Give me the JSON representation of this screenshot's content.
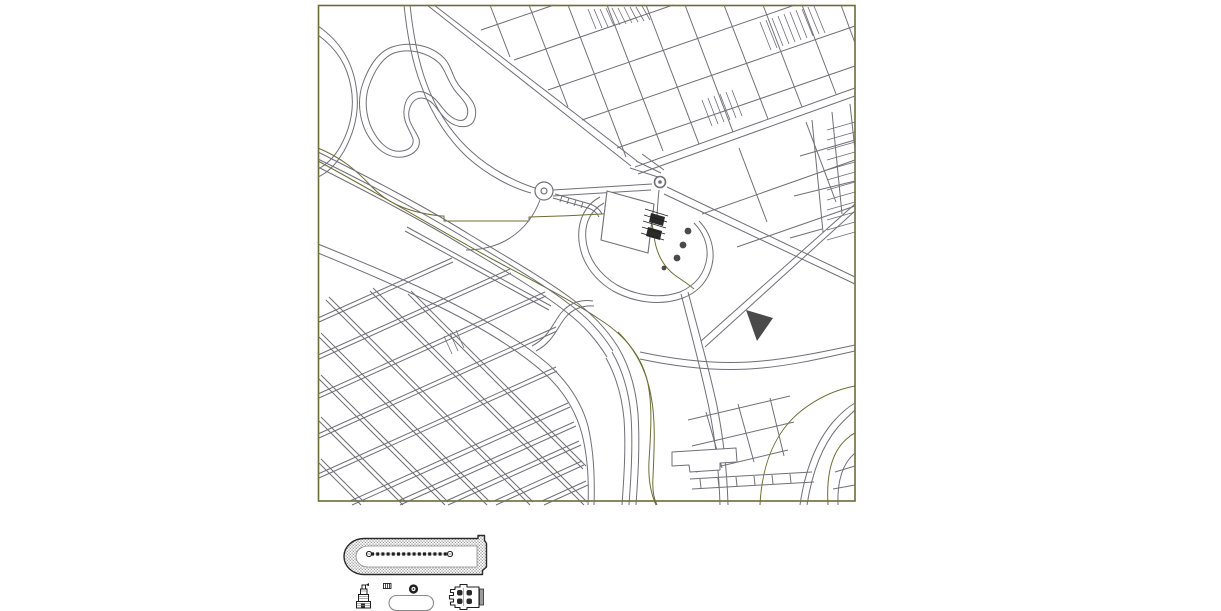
{
  "canvas": {
    "width": 1221,
    "height": 611,
    "background": "#ffffff"
  },
  "colors": {
    "olive": "#6c6c34",
    "street": "#6f6f78",
    "dark": "#1f1f1f",
    "wall": "#2a2a2a",
    "stipple": "#9c9c9c",
    "gray": "#8a8a8a",
    "tree": "#4a4a4a",
    "white": "#ffffff"
  },
  "frame": {
    "x": 318.5,
    "y": 5.5,
    "w": 536.5,
    "h": 495.5
  },
  "layers": [
    {
      "name": "park-contours-olive",
      "stroke": "olive",
      "w": 1,
      "paths": [
        "M318,148 C342,158 356,170 372,187 C390,206 414,213 441,216 L444,216 L444,221 L529,221 L529,217 L560,216 C588,215 618,213 639,212 C650,212 652,220 654,236 C656,252 662,266 676,276 C682,280 688,284 694,289",
        "M318,161 C372,190 432,226 492,259 C541,285 572,301 599,319 C623,334 639,353 646,376 C653,399 651,431 649,461 C648,481 651,494 656,505",
        "M618,332 C637,351 647,373 651,396 C656,421 654,452 653,477 C652,491 654,499 657,505",
        "M828,505 C826,472 833,449 849,437 C851,435 853,434 855,433",
        "M760,505 C762,463 776,431 801,411 C820,396 839,389 855,386"
      ]
    },
    {
      "name": "park-roads",
      "stroke": "street",
      "w": 1,
      "paths": [
        "M318,26 C340,41 352,61 356,86 C360,109 355,131 344,151 C335,166 327,173 318,177",
        "M318,35 C337,49 347,65 351,87 C355,109 350,129 340,147 C333,159 326,165 318,169",
        "M392,47 C410,41 431,45 444,58 C452,66 452,78 461,88 C471,98 478,106 475,118 C472,129 458,129 448,121 C439,114 436,104 428,100 C419,95 411,100 409,111 C407,122 415,129 419,139 C421,147 415,155 403,157 C387,159 375,148 367,134 C359,119 357,99 363,83 C369,66 378,52 392,47 Z",
        "M394,53 C409,48 427,52 439,63 C446,70 447,81 456,92 C464,101 470,107 467,116 C464,123 456,121 449,115 C441,108 438,99 428,94 C417,88 405,94 404,111 C403,122 410,130 413,139 C414,145 410,150 402,151 C390,153 380,144 373,131 C366,118 364,100 369,86 C374,71 383,57 394,53 Z",
        "M410,5 C413,33 418,60 426,82 C436,110 452,134 472,152 C492,170 516,182 535,188",
        "M404,5 C407,34 412,62 421,85 C431,113 447,138 467,157 C487,175 512,188 531,193",
        "M427,5 L631,166",
        "M434,5 L637,161",
        "M553,190 L652,184",
        "M553,196 L651,190",
        "M553,198 L588,208 C594,210 597,213 599,217",
        "M555,194 L590,204 C596,206 600,210 602,214",
        "M562,196 L560,202",
        "M569,198 L567,204",
        "M576,200 L574,206",
        "M583,202 L581,208",
        "M630,168 L658,177",
        "M636,161 L661,173",
        "M642,154 L664,170",
        "M540,200 C534,216 524,229 510,238 C498,246 482,250 466,250",
        "M659,190 C658,200 657,210 657,220"
      ]
    },
    {
      "name": "grid-northeast",
      "stroke": "street",
      "w": 1,
      "paths": [
        "M481,30 L554,5",
        "M514,60 L673,5",
        "M548,90 L795,5",
        "M582,120 L855,26",
        "M617,148 L855,66",
        "M635,167 L855,88",
        "M638,174 L855,96",
        "M702,214 L855,160",
        "M737,247 L855,206",
        "M490,5 L510,57",
        "M529,5 L568,107",
        "M568,5 L626,157",
        "M607,5 L663,151",
        "M646,5 L699,144",
        "M685,5 L733,132",
        "M724,5 L768,119",
        "M763,5 L802,107",
        "M802,5 L836,94",
        "M841,5 L855,43",
        "M739,148 L767,222",
        "M806,122 L836,202",
        "M812,120 L823,232",
        "M832,112 L842,214",
        "M850,104 L855,150",
        "M800,156 L855,140",
        "M794,196 L855,181",
        "M790,238 L822,229",
        "M667,187 L855,277",
        "M664,194 L855,284",
        "M701,341 L855,204",
        "M705,347 L855,211",
        "M688,292 C698,330 709,368 717,406 C723,436 727,470 728,505",
        "M681,294 C691,332 701,370 709,408 C715,438 719,471 720,505"
      ]
    },
    {
      "name": "lot-hatch-strips",
      "stroke": "street",
      "w": 0.8,
      "paths": [
        "M588,9 L596,29",
        "M594,9 L602,28",
        "M600,9 L608,27",
        "M606,8 L614,26",
        "M612,8 L620,25",
        "M618,8 L626,24",
        "M624,7 L632,23",
        "M630,7 L638,22",
        "M636,7 L644,21",
        "M642,6 L650,20",
        "M760,22 L771,50",
        "M766,20 L777,48",
        "M772,18 L783,46",
        "M778,16 L789,44",
        "M784,14 L795,42",
        "M790,12 L801,40",
        "M796,10 L807,38",
        "M802,9 L813,36",
        "M808,7 L819,34",
        "M814,6 L825,33",
        "M827,130 L855,122",
        "M827,140 L855,132",
        "M827,150 L855,142",
        "M827,160 L855,152",
        "M827,170 L855,162",
        "M827,180 L855,172",
        "M827,190 L855,182",
        "M827,200 L855,192",
        "M827,210 L855,202",
        "M827,220 L855,212",
        "M827,230 L855,222",
        "M827,240 L855,232",
        "M702,100 L712,126",
        "M708,98 L718,124",
        "M714,96 L724,122",
        "M720,94 L730,120",
        "M726,92 L736,118",
        "M732,90 L742,116",
        "M444,336 L452,354",
        "M450,333 L458,351",
        "M456,330 L464,348"
      ]
    },
    {
      "name": "rail-and-river",
      "stroke": "street",
      "w": 1,
      "paths": [
        "M318,152 C372,179 424,206 472,236 C514,261 548,281 572,299 C594,315 608,331 618,347",
        "M318,159 C371,185 422,212 470,241 C512,266 546,286 569,304 C590,319 603,335 613,351",
        "M318,167 C369,193 420,219 467,248 C509,273 542,293 565,311 C585,326 597,341 607,357",
        "M405,231 C452,257 502,284 549,310",
        "M407,227 C454,253 504,280 551,306",
        "M618,347 C630,367 636,390 638,414 C640,445 638,476 636,505",
        "M612,352 C623,371 629,393 631,416 C633,446 631,477 629,505",
        "M606,358 C616,376 622,397 624,419 C626,447 624,477 622,505",
        "M318,253 C362,271 404,289 444,309 C484,329 519,351 544,373 C564,391 576,412 582,434 C588,458 589,482 588,505",
        "M318,244 C362,262 406,280 446,300 C486,320 522,342 548,364 C569,383 582,404 588,426 C594,452 595,478 594,505",
        "M532,346 C549,337 553,323 561,313 C569,303 581,299 593,301",
        "M536,351 C553,342 557,328 565,318 C572,309 583,305 594,306",
        "M640,352 C682,361 722,365 762,361 C794,358 827,351 855,345",
        "M640,359 C682,368 722,372 762,368 C795,365 828,357 855,351",
        "M690,479 L812,472",
        "M692,489 L814,482",
        "M700,479 L701,488",
        "M718,478 L719,487",
        "M736,477 L737,486",
        "M754,476 L755,485",
        "M772,475 L773,484",
        "M790,474 L791,483"
      ]
    },
    {
      "name": "grid-southwest",
      "stroke": "street",
      "w": 1,
      "paths": [
        "M326,300 L530,505",
        "M329,297 L533,502",
        "M318,336 L487,505",
        "M321,333 L490,502",
        "M318,378 L445,505",
        "M321,375 L448,502",
        "M318,420 L403,505",
        "M321,417 L406,502",
        "M318,462 L361,505",
        "M321,459 L364,502",
        "M370,291 L584,505",
        "M373,288 L587,502",
        "M408,294 L583,469",
        "M411,291 L586,466",
        "M318,318 L452,258",
        "M319,322 L453,262",
        "M318,355 L510,269",
        "M319,359 L511,273",
        "M318,394 L545,292",
        "M319,398 L546,296",
        "M318,434 L556,327",
        "M319,438 L557,331",
        "M318,474 L556,367",
        "M319,478 L557,371",
        "M352,505 L570,407",
        "M350,501 L568,403",
        "M400,505 L576,426",
        "M398,501 L574,422",
        "M448,505 L581,445",
        "M446,501 L579,441",
        "M496,505 L584,465",
        "M494,501 L582,461",
        "M544,505 L588,485",
        "M542,501 L586,481"
      ]
    },
    {
      "name": "southeast-quarter",
      "stroke": "street",
      "w": 1,
      "paths": [
        "M688,420 L790,396",
        "M692,446 L794,422",
        "M696,472 L788,450",
        "M706,412 L722,468",
        "M738,404 L754,462",
        "M770,398 L784,456",
        "M838,505 C837,480 843,463 855,453",
        "M835,472 L855,466",
        "M833,489 L855,485",
        "M800,505 C805,471 816,442 833,422 C841,413 848,407 855,403",
        "M807,505 C812,473 822,446 838,427 C845,419 851,414 855,410"
      ]
    },
    {
      "name": "riverside-building",
      "stroke": "street",
      "w": 1,
      "fill": "white",
      "paths": [
        "M672,452 L736,448 L737,462 L720,463 L720,470 L690,472 L689,465 L672,466 Z"
      ]
    },
    {
      "name": "solid-block",
      "stroke": "none",
      "fill": "tree",
      "paths": [
        "M746,310 L773,318 L757,341 Z"
      ]
    },
    {
      "name": "capitol-site",
      "stroke": "street",
      "w": 1,
      "paths": [
        "M600,197 C585,205 577,221 579,241 C581,261 593,279 613,291 C635,303 661,306 683,298 C701,291 711,277 713,259 C714,245 709,231 699,221",
        "M604,203 C591,210 584,223 586,240 C588,258 599,274 617,285 C637,296 660,299 680,292 C696,285 705,273 707,257 C708,244 703,232 694,223"
      ]
    },
    {
      "name": "capitol-building",
      "stroke": "street",
      "w": 1.1,
      "fill": "white",
      "paths": [
        "M607,191 L654,204 L648,253 L601,240 Z"
      ]
    },
    {
      "name": "capitol-steps",
      "stroke": "none",
      "fill": "wall",
      "paths": [
        "M651,213 L665,217 L663,226 L649,222 Z",
        "M648,227 L662,231 L660,240 L646,236 Z"
      ]
    },
    {
      "name": "capitol-steps-hatch",
      "stroke": "dark",
      "w": 0.8,
      "paths": [
        "M645,209 L668,216",
        "M644,215 L667,222",
        "M643,221 L666,228",
        "M642,227 L665,234",
        "M641,233 L664,240"
      ]
    },
    {
      "name": "site-trees",
      "circles": [
        {
          "cx": 688,
          "cy": 231,
          "r": 3.4,
          "fill": "tree"
        },
        {
          "cx": 683,
          "cy": 245,
          "r": 3.4,
          "fill": "tree"
        },
        {
          "cx": 677,
          "cy": 258,
          "r": 3.4,
          "fill": "tree"
        },
        {
          "cx": 664,
          "cy": 268,
          "r": 2.4,
          "fill": "tree"
        }
      ]
    },
    {
      "name": "roundabouts",
      "circles": [
        {
          "cx": 544,
          "cy": 191,
          "r": 9,
          "stroke": "street",
          "w": 1.2,
          "fill": "none"
        },
        {
          "cx": 544,
          "cy": 191,
          "r": 3,
          "stroke": "street",
          "w": 1.2,
          "fill": "none"
        },
        {
          "cx": 660,
          "cy": 182,
          "r": 5.5,
          "stroke": "street",
          "w": 1.6,
          "fill": "none"
        },
        {
          "cx": 660,
          "cy": 182,
          "r": 1.8,
          "fill": "street"
        }
      ]
    },
    {
      "name": "grandstand-wall",
      "stroke": "wall",
      "w": 1.4,
      "fill": "pattern",
      "paths": [
        "M364,538.5 L478,538.5 L478,535.5 L484.5,535.5 L484.5,540.5 L486.5,543.5 L486.5,567 L482.5,570.5 L482.5,574.5 L364,574.5 A20,18 0 0 1 364,538.5 Z"
      ]
    },
    {
      "name": "grandstand-infield",
      "stroke": "gray",
      "w": 0.8,
      "fill": "white",
      "paths": [
        "M368,546 L477,546 L477,567 L368,567 A12,10.5 0 0 1 368,546 Z"
      ]
    },
    {
      "name": "grandstand-seat-row-underlay",
      "stroke": "gray",
      "w": 0.8,
      "paths": [
        "M366,554 L453,554"
      ]
    },
    {
      "name": "grandstand-seat-row",
      "stroke": "dark",
      "w": 3.2,
      "dash": "3 2.2",
      "paths": [
        "M371,554 L448,554"
      ]
    },
    {
      "name": "grandstand-row-ends",
      "circles": [
        {
          "cx": 369,
          "cy": 554,
          "r": 2.6,
          "stroke": "dark",
          "w": 1,
          "fill": "none"
        },
        {
          "cx": 450,
          "cy": 554,
          "r": 2.6,
          "stroke": "dark",
          "w": 1,
          "fill": "none"
        }
      ]
    },
    {
      "name": "statue-detail",
      "stroke": "dark",
      "w": 1,
      "fill": "white",
      "rects": [
        {
          "x": 356.5,
          "y": 601.5,
          "w": 14,
          "h": 6.5
        },
        {
          "x": 358.5,
          "y": 594.5,
          "w": 10,
          "h": 7
        },
        {
          "x": 360.5,
          "y": 589,
          "w": 6.5,
          "h": 5.5
        },
        {
          "x": 362,
          "y": 585,
          "w": 3.5,
          "h": 4
        }
      ]
    },
    {
      "name": "statue-flag",
      "stroke": "none",
      "fill": "dark",
      "paths": [
        "M365.5,585 L369,583 L369,586 Z"
      ]
    },
    {
      "name": "statue-base-door",
      "stroke": "none",
      "fill": "wall",
      "rects": [
        {
          "x": 361,
          "y": 603,
          "w": 4,
          "h": 4.5
        }
      ]
    },
    {
      "name": "statue-hatch",
      "stroke": "gray",
      "w": 0.7,
      "paths": [
        "M357,603.5 L370,603.5",
        "M357,605.5 L370,605.5",
        "M359,596.5 L368,596.5",
        "M359,598.5 L368,598.5",
        "M361,591 L367,591"
      ]
    },
    {
      "name": "small-block-detail",
      "stroke": "dark",
      "w": 0.9,
      "fill": "white",
      "rects": [
        {
          "x": 383.5,
          "y": 583.5,
          "w": 7.5,
          "h": 5
        }
      ]
    },
    {
      "name": "small-block-hatch",
      "stroke": "dark",
      "w": 0.8,
      "paths": [
        "M385.5,583.5 L385.5,588.5",
        "M387.5,583.5 L387.5,588.5",
        "M389.5,583.5 L389.5,588.5"
      ]
    },
    {
      "name": "fountain-detail",
      "circles": [
        {
          "cx": 413.5,
          "cy": 589,
          "r": 4.6,
          "fill": "dark"
        },
        {
          "cx": 413.5,
          "cy": 589,
          "r": 2.1,
          "fill": "white"
        },
        {
          "cx": 413.5,
          "cy": 589,
          "r": 0.9,
          "fill": "dark"
        }
      ]
    },
    {
      "name": "pool-detail",
      "stroke": "gray",
      "w": 1.1,
      "fill": "white",
      "rects": [
        {
          "x": 389,
          "y": 595.5,
          "w": 44.5,
          "h": 15,
          "rx": 7.5
        }
      ]
    },
    {
      "name": "castle-detail",
      "stroke": "dark",
      "w": 1.1,
      "fill": "white",
      "paths": [
        "M479,587 L467,587 L467,584.5 L460,584.5 L460,587 L455,587 L455,589.5 L450.5,589.5 L450.5,592.5 L453.5,592.5 L453.5,595.5 L449.5,595.5 L449.5,599 L453.5,599 L453.5,602 L450.5,602 L450.5,605 L455,605 L455,607.5 L460,607.5 L460,609.5 L467,609.5 L467,607.5 L479,607.5 Z"
      ]
    },
    {
      "name": "castle-wing",
      "stroke": "wall",
      "w": 0.8,
      "fill": "stipple",
      "rects": [
        {
          "x": 479.5,
          "y": 589,
          "w": 4,
          "h": 16
        }
      ]
    },
    {
      "name": "castle-midline",
      "stroke": "gray",
      "w": 0.7,
      "paths": [
        "M463.5,588 L463.5,606"
      ]
    },
    {
      "name": "castle-piers",
      "stroke": "none",
      "fill": "wall",
      "rects": [
        {
          "x": 457,
          "y": 590,
          "w": 5.5,
          "h": 5.5,
          "rx": 2
        },
        {
          "x": 466.5,
          "y": 590,
          "w": 5.5,
          "h": 5.5,
          "rx": 2
        },
        {
          "x": 457,
          "y": 598.5,
          "w": 5.5,
          "h": 5.5,
          "rx": 2
        },
        {
          "x": 466.5,
          "y": 598.5,
          "w": 5.5,
          "h": 5.5,
          "rx": 2
        }
      ]
    }
  ]
}
